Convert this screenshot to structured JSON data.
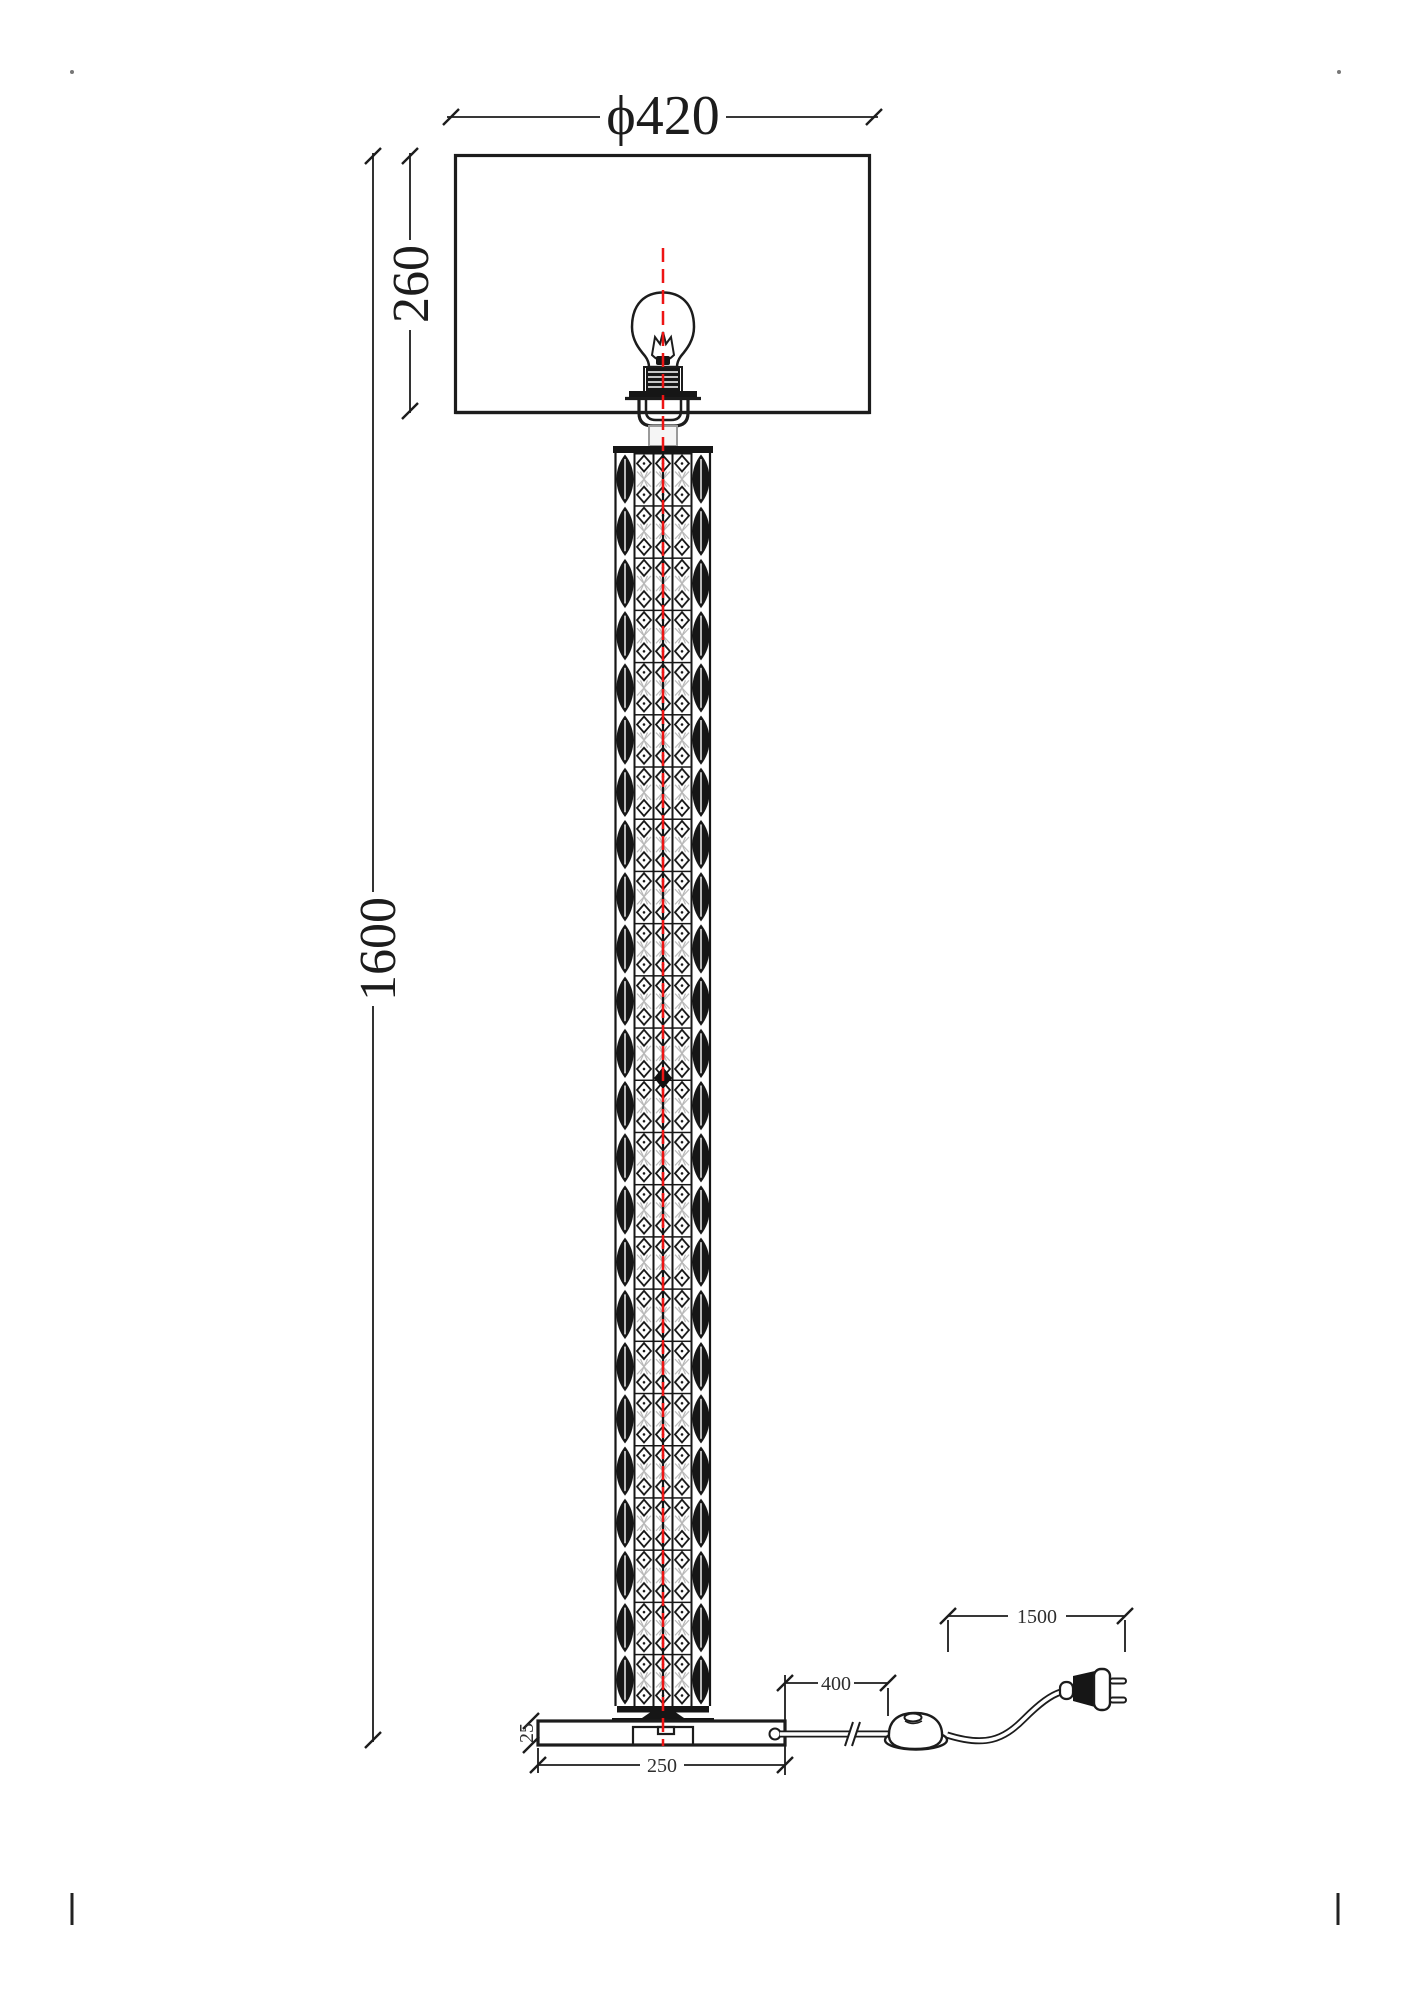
{
  "title": "floor-lamp-dimension-drawing",
  "dimensions": {
    "shade_diameter": "ϕ420",
    "shade_height": "260",
    "total_height": "1600",
    "base_width": "250",
    "base_thickness": "25",
    "switch_distance": "400",
    "cord_length": "1500"
  },
  "colors": {
    "ink": "#1c1c1c",
    "centerline_red": "#ee1414",
    "lattice_gray": "#b8b8b8"
  }
}
